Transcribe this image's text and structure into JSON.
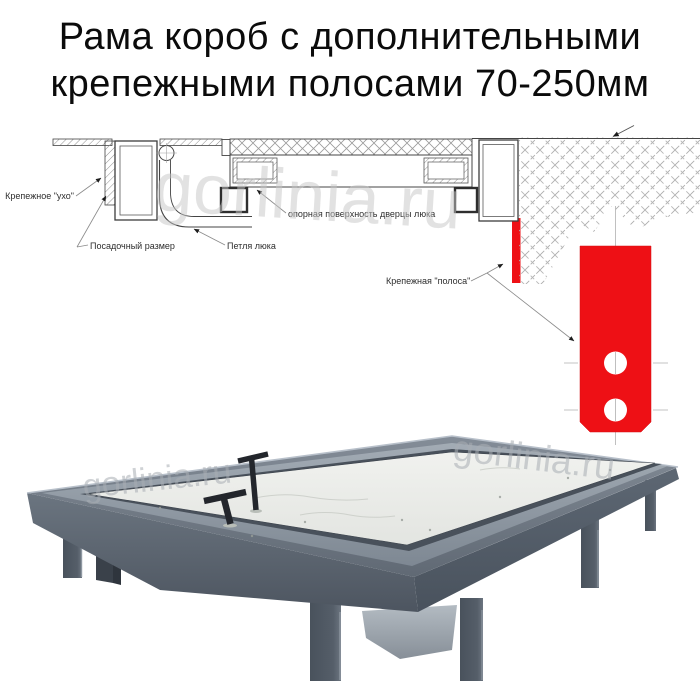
{
  "title": {
    "line1": "Рама короб с дополнительными",
    "line2": "крепежными полосами 70-250мм"
  },
  "watermark": {
    "text": "gorlinia.ru"
  },
  "diagram": {
    "labels": {
      "ear": "Крепежное \"ухо\"",
      "seat_size": "Посадочный размер",
      "hinge": "Петля люка",
      "support_surface": "опорная поверхность дверцы люка",
      "strip": "Крепежная \"полоса\""
    },
    "colors": {
      "strip_red": "#ee1015"
    }
  }
}
